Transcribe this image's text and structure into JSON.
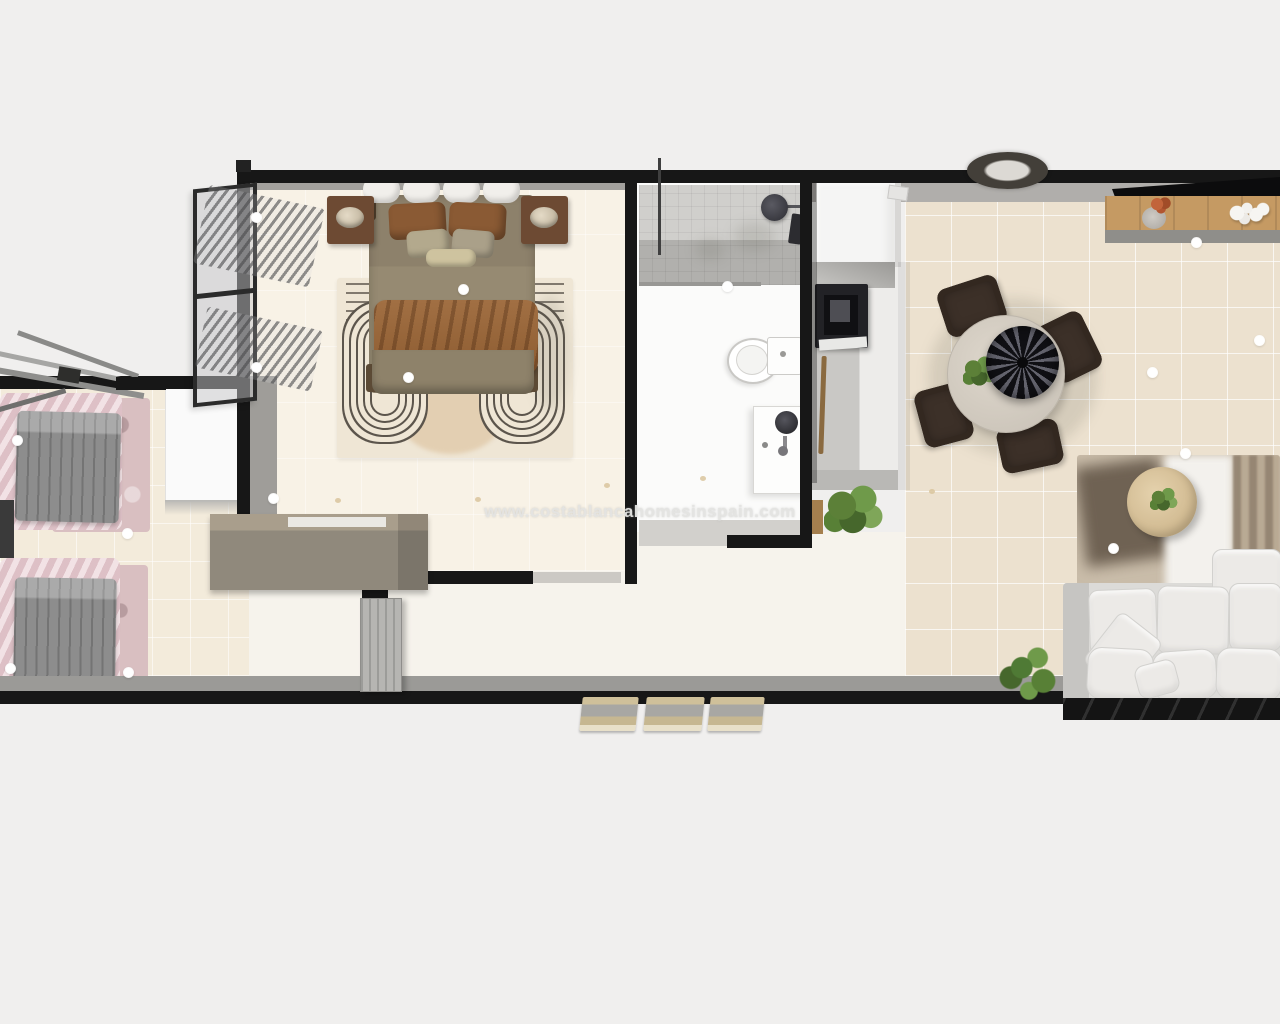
{
  "watermark": "www.costablancahomesinspain.com",
  "scene": {
    "type": "3d-floorplan-top-view",
    "rooms": [
      "master-bedroom",
      "bathroom",
      "kitchen",
      "dining-area",
      "living-room",
      "second-bedroom",
      "hallway-entry"
    ],
    "furniture": [
      "double-bed",
      "nightstands",
      "table-lamps",
      "patterned-area-rug",
      "window-with-curtains",
      "desk-sideboard",
      "interior-door",
      "wardrobe",
      "single-beds",
      "shower",
      "toilet",
      "bathroom-vanity",
      "tall-fridge-unit",
      "cooktop",
      "kitchen-counter",
      "round-dining-table",
      "dining-chairs",
      "pendant-lamp",
      "wall-mounted-tv",
      "wood-sideboard",
      "flower-vase",
      "coral-decor",
      "wall-wreath",
      "living-rug",
      "round-coffee-table",
      "corner-sofa",
      "potted-plants",
      "entry-steps",
      "ceiling-lights"
    ]
  },
  "palette": {
    "background": "#f0efee",
    "walls": "#171717",
    "bedroom_floor": "#f8f2e6",
    "living_floor": "#ece1cf",
    "annex_floor": "#f3ebdb",
    "bath_floor": "#fbfbfa",
    "bed_blanket": "#968a72",
    "bed_throw": "#8d5c31",
    "pink_bedding": "#e9cfd4",
    "gray_duvet": "#8d8d8d",
    "sofa": "#eceae7",
    "console_wood": "#c59a63",
    "coffee_table_wood": "#dcc7a2",
    "chair_brown": "#3c3028",
    "plant_green": "#5c8038"
  }
}
